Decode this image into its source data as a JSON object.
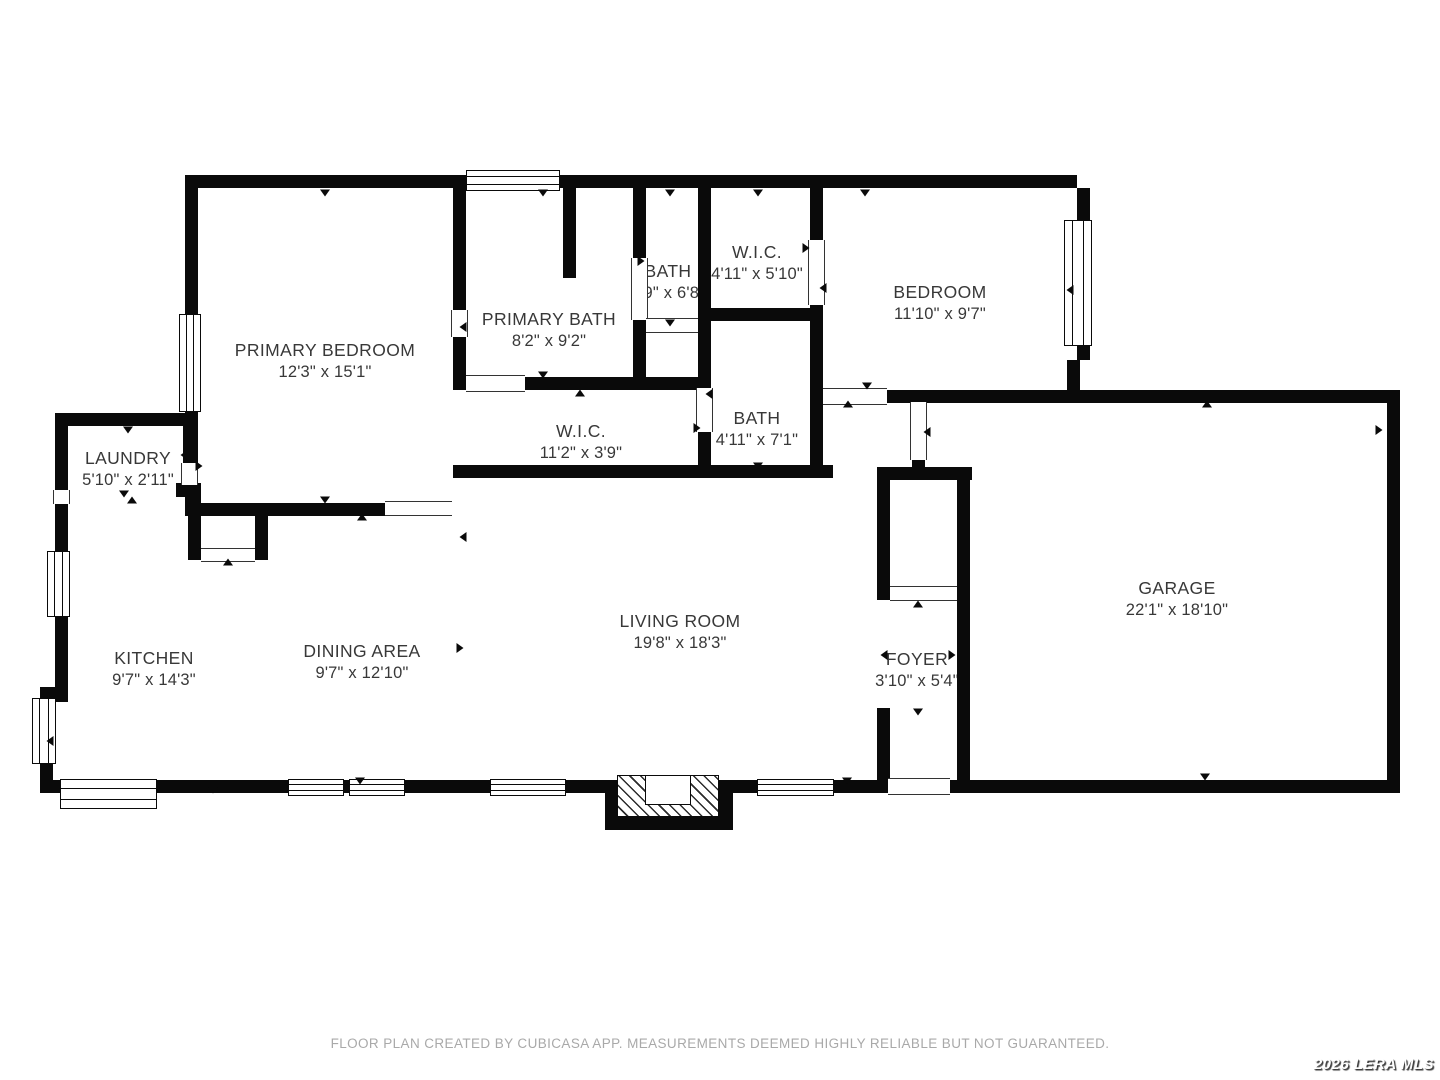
{
  "footer": {
    "text": "FLOOR PLAN CREATED BY CUBICASA APP. MEASUREMENTS DEEMED HIGHLY RELIABLE BUT NOT GUARANTEED."
  },
  "watermark": {
    "text": "2026 LERA MLS"
  },
  "plan": {
    "background_color": "#ffffff",
    "wall_color": "#0a0a0a",
    "label_color": "#383838",
    "rooms": [
      {
        "id": "primary-bedroom",
        "name": "PRIMARY BEDROOM",
        "dims": "12'3\" x 15'1\"",
        "cx": 325,
        "cy": 361
      },
      {
        "id": "primary-bath",
        "name": "PRIMARY BATH",
        "dims": "8'2\" x 9'2\"",
        "cx": 549,
        "cy": 330
      },
      {
        "id": "bath-1",
        "name": "BATH",
        "dims": "2'9\" x 6'8\"",
        "cx": 668,
        "cy": 282
      },
      {
        "id": "wic-1",
        "name": "W.I.C.",
        "dims": "4'11\" x 5'10\"",
        "cx": 757,
        "cy": 263
      },
      {
        "id": "bedroom",
        "name": "BEDROOM",
        "dims": "11'10\" x 9'7\"",
        "cx": 940,
        "cy": 303
      },
      {
        "id": "bath-2",
        "name": "BATH",
        "dims": "4'11\" x 7'1\"",
        "cx": 757,
        "cy": 429
      },
      {
        "id": "wic-2",
        "name": "W.I.C.",
        "dims": "11'2\" x 3'9\"",
        "cx": 581,
        "cy": 442
      },
      {
        "id": "laundry",
        "name": "LAUNDRY",
        "dims": "5'10\" x 2'11\"",
        "cx": 128,
        "cy": 469
      },
      {
        "id": "kitchen",
        "name": "KITCHEN",
        "dims": "9'7\" x 14'3\"",
        "cx": 154,
        "cy": 669
      },
      {
        "id": "dining-area",
        "name": "DINING AREA",
        "dims": "9'7\" x 12'10\"",
        "cx": 362,
        "cy": 662
      },
      {
        "id": "living-room",
        "name": "LIVING ROOM",
        "dims": "19'8\" x 18'3\"",
        "cx": 680,
        "cy": 632
      },
      {
        "id": "foyer",
        "name": "FOYER",
        "dims": "3'10\" x 5'4\"",
        "cx": 917,
        "cy": 670
      },
      {
        "id": "garage",
        "name": "GARAGE",
        "dims": "22'1\" x 18'10\"",
        "cx": 1177,
        "cy": 599
      }
    ],
    "walls": [
      [
        185,
        175,
        892,
        13
      ],
      [
        185,
        175,
        13,
        341
      ],
      [
        185,
        503,
        203,
        13
      ],
      [
        453,
        188,
        13,
        202
      ],
      [
        563,
        188,
        13,
        90
      ],
      [
        633,
        188,
        13,
        202
      ],
      [
        698,
        188,
        13,
        290
      ],
      [
        698,
        308,
        124,
        13
      ],
      [
        810,
        188,
        13,
        290
      ],
      [
        633,
        377,
        78,
        13
      ],
      [
        453,
        377,
        258,
        13
      ],
      [
        453,
        465,
        380,
        13
      ],
      [
        823,
        390,
        577,
        13
      ],
      [
        1067,
        360,
        13,
        30
      ],
      [
        1077,
        188,
        13,
        172
      ],
      [
        912,
        402,
        13,
        65
      ],
      [
        877,
        467,
        95,
        13
      ],
      [
        877,
        467,
        13,
        133
      ],
      [
        957,
        467,
        13,
        326
      ],
      [
        877,
        708,
        13,
        85
      ],
      [
        40,
        780,
        850,
        13
      ],
      [
        950,
        780,
        450,
        13
      ],
      [
        1387,
        390,
        13,
        403
      ],
      [
        55,
        413,
        140,
        13
      ],
      [
        55,
        413,
        13,
        280
      ],
      [
        40,
        687,
        28,
        15
      ],
      [
        40,
        687,
        13,
        106
      ],
      [
        183,
        413,
        13,
        52
      ],
      [
        176,
        483,
        25,
        14
      ],
      [
        188,
        483,
        13,
        77
      ],
      [
        255,
        503,
        13,
        57
      ]
    ],
    "windows": [
      {
        "x": 466,
        "y": 170,
        "w": 94,
        "h": 21,
        "o": "h"
      },
      {
        "x": 179,
        "y": 314,
        "w": 22,
        "h": 98,
        "o": "v"
      },
      {
        "x": 1064,
        "y": 220,
        "w": 28,
        "h": 126,
        "o": "v"
      },
      {
        "x": 47,
        "y": 551,
        "w": 23,
        "h": 66,
        "o": "v"
      },
      {
        "x": 32,
        "y": 698,
        "w": 24,
        "h": 66,
        "o": "v"
      },
      {
        "x": 60,
        "y": 779,
        "w": 97,
        "h": 30,
        "o": "h"
      },
      {
        "x": 288,
        "y": 779,
        "w": 56,
        "h": 17,
        "o": "h"
      },
      {
        "x": 349,
        "y": 779,
        "w": 56,
        "h": 17,
        "o": "h"
      },
      {
        "x": 490,
        "y": 779,
        "w": 76,
        "h": 17,
        "o": "h"
      },
      {
        "x": 757,
        "y": 779,
        "w": 77,
        "h": 17,
        "o": "h"
      }
    ],
    "openings": [
      {
        "x": 451,
        "y": 310,
        "w": 17,
        "h": 27,
        "o": "v"
      },
      {
        "x": 631,
        "y": 258,
        "w": 17,
        "h": 62,
        "o": "v"
      },
      {
        "x": 646,
        "y": 318,
        "w": 52,
        "h": 15,
        "o": "h"
      },
      {
        "x": 466,
        "y": 375,
        "w": 59,
        "h": 17,
        "o": "h"
      },
      {
        "x": 808,
        "y": 240,
        "w": 17,
        "h": 65,
        "o": "v"
      },
      {
        "x": 696,
        "y": 388,
        "w": 17,
        "h": 44,
        "o": "v"
      },
      {
        "x": 823,
        "y": 388,
        "w": 64,
        "h": 17,
        "o": "h"
      },
      {
        "x": 910,
        "y": 402,
        "w": 17,
        "h": 58,
        "o": "v"
      },
      {
        "x": 890,
        "y": 586,
        "w": 67,
        "h": 15,
        "o": "h"
      },
      {
        "x": 888,
        "y": 778,
        "w": 62,
        "h": 17,
        "o": "h"
      },
      {
        "x": 385,
        "y": 501,
        "w": 67,
        "h": 15,
        "o": "h"
      },
      {
        "x": 201,
        "y": 548,
        "w": 54,
        "h": 14,
        "o": "h"
      },
      {
        "x": 181,
        "y": 463,
        "w": 17,
        "h": 22,
        "o": "v"
      },
      {
        "x": 53,
        "y": 490,
        "w": 17,
        "h": 14,
        "o": "v"
      }
    ],
    "arrows": [
      {
        "x": 325,
        "y": 193,
        "d": "d"
      },
      {
        "x": 543,
        "y": 193,
        "d": "d"
      },
      {
        "x": 670,
        "y": 193,
        "d": "d"
      },
      {
        "x": 758,
        "y": 193,
        "d": "d"
      },
      {
        "x": 865,
        "y": 193,
        "d": "d"
      },
      {
        "x": 128,
        "y": 430,
        "d": "d"
      },
      {
        "x": 124,
        "y": 494,
        "d": "d"
      },
      {
        "x": 132,
        "y": 500,
        "d": "u"
      },
      {
        "x": 184,
        "y": 455,
        "d": "l"
      },
      {
        "x": 199,
        "y": 466,
        "d": "r"
      },
      {
        "x": 50,
        "y": 741,
        "d": "l"
      },
      {
        "x": 213,
        "y": 790,
        "d": "d"
      },
      {
        "x": 325,
        "y": 500,
        "d": "d"
      },
      {
        "x": 362,
        "y": 517,
        "d": "u"
      },
      {
        "x": 228,
        "y": 562,
        "d": "u"
      },
      {
        "x": 463,
        "y": 327,
        "d": "l"
      },
      {
        "x": 543,
        "y": 375,
        "d": "d"
      },
      {
        "x": 580,
        "y": 393,
        "d": "u"
      },
      {
        "x": 641,
        "y": 261,
        "d": "r"
      },
      {
        "x": 670,
        "y": 323,
        "d": "d"
      },
      {
        "x": 806,
        "y": 248,
        "d": "r"
      },
      {
        "x": 823,
        "y": 288,
        "d": "l"
      },
      {
        "x": 709,
        "y": 394,
        "d": "l"
      },
      {
        "x": 697,
        "y": 428,
        "d": "r"
      },
      {
        "x": 758,
        "y": 466,
        "d": "d"
      },
      {
        "x": 867,
        "y": 386,
        "d": "d"
      },
      {
        "x": 848,
        "y": 404,
        "d": "u"
      },
      {
        "x": 1070,
        "y": 290,
        "d": "l"
      },
      {
        "x": 927,
        "y": 432,
        "d": "l"
      },
      {
        "x": 918,
        "y": 604,
        "d": "u"
      },
      {
        "x": 884,
        "y": 655,
        "d": "l"
      },
      {
        "x": 952,
        "y": 655,
        "d": "r"
      },
      {
        "x": 918,
        "y": 712,
        "d": "d"
      },
      {
        "x": 360,
        "y": 781,
        "d": "d"
      },
      {
        "x": 847,
        "y": 781,
        "d": "d"
      },
      {
        "x": 1207,
        "y": 404,
        "d": "u"
      },
      {
        "x": 1379,
        "y": 430,
        "d": "r"
      },
      {
        "x": 1205,
        "y": 777,
        "d": "d"
      },
      {
        "x": 460,
        "y": 648,
        "d": "r"
      },
      {
        "x": 463,
        "y": 537,
        "d": "l"
      }
    ],
    "fireplace": {
      "outer": [
        605,
        780,
        128,
        50
      ],
      "hatch": [
        617,
        775,
        102,
        42
      ],
      "inner": [
        645,
        775,
        46,
        30
      ]
    }
  }
}
